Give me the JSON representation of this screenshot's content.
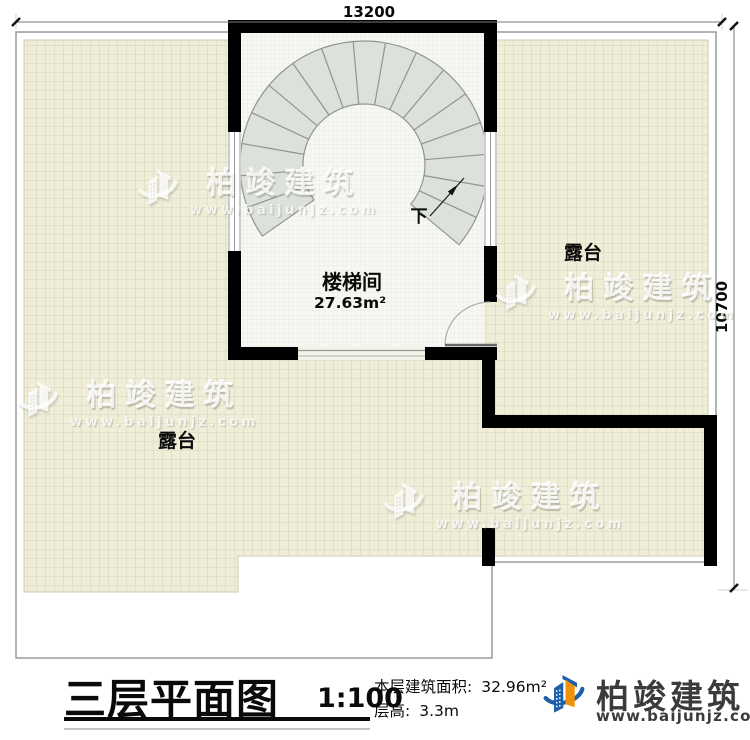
{
  "plan": {
    "dim_width": "13200",
    "dim_height": "10700",
    "stairwell_label": "楼梯间",
    "stairwell_area": "27.63m²",
    "terrace_right_label": "露台",
    "terrace_bottom_label": "露台",
    "stairs_down_label": "下"
  },
  "watermark": {
    "brand": "柏竣建筑",
    "website": "www.baijunjz.com"
  },
  "title_block": {
    "title": "三层平面图",
    "scale": "1:100",
    "area_label": "本层建筑面积:",
    "area_value": "32.96m²",
    "height_label": "层高:",
    "height_value": "3.3m"
  },
  "logo": {
    "brand": "柏竣建筑",
    "website": "www.baijunjz.com"
  },
  "colors": {
    "wall": "#000000",
    "tile": "#f0edd9",
    "tile_line": "#d9d5bb",
    "stair_tread": "#dce2da",
    "logo_blue": "#1d5fa8",
    "logo_orange": "#f0930c"
  }
}
